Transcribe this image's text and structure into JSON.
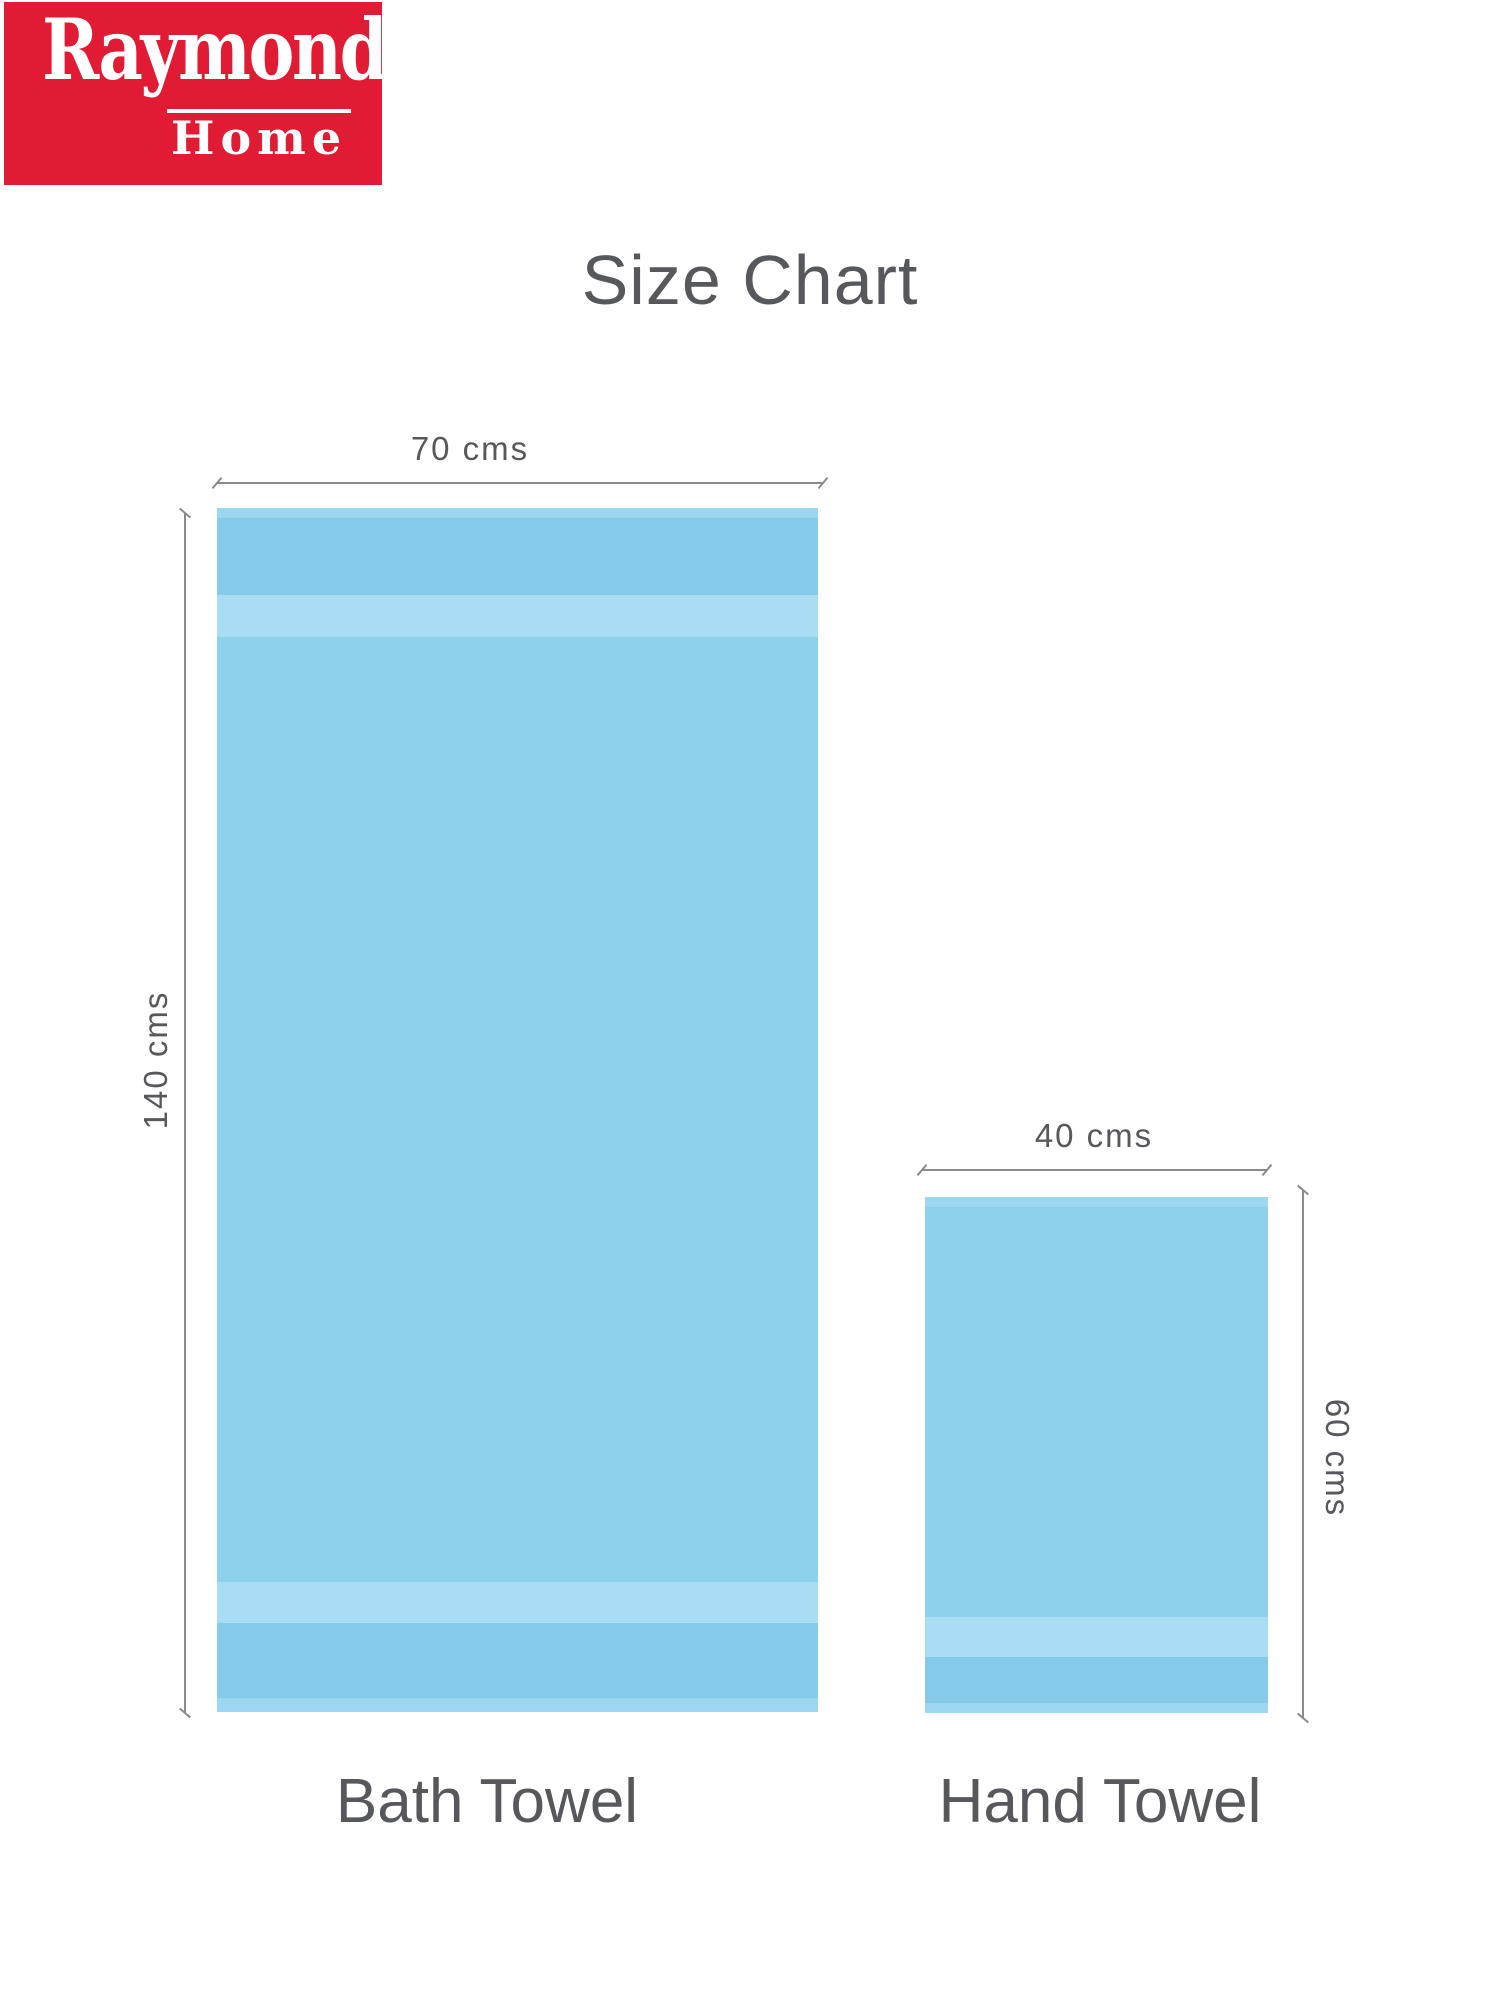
{
  "brand": {
    "name": "Raymond",
    "sub_brand": "Home"
  },
  "title": "Size Chart",
  "towels": [
    {
      "name": "Bath Towel",
      "width_label": "70 cms",
      "height_label": "140 cms"
    },
    {
      "name": "Hand Towel",
      "width_label": "40 cms",
      "height_label": "60 cms"
    }
  ],
  "colors": {
    "brand_red": "#e01b33",
    "brand_text": "#ffffff",
    "label_gray": "#57585b",
    "line_gray": "#8a8a8a",
    "towel_main": "#8dd1ec",
    "towel_band": "#85cbe9",
    "towel_stripe": "#a9ddf4",
    "towel_edge": "#9dd6ef"
  }
}
